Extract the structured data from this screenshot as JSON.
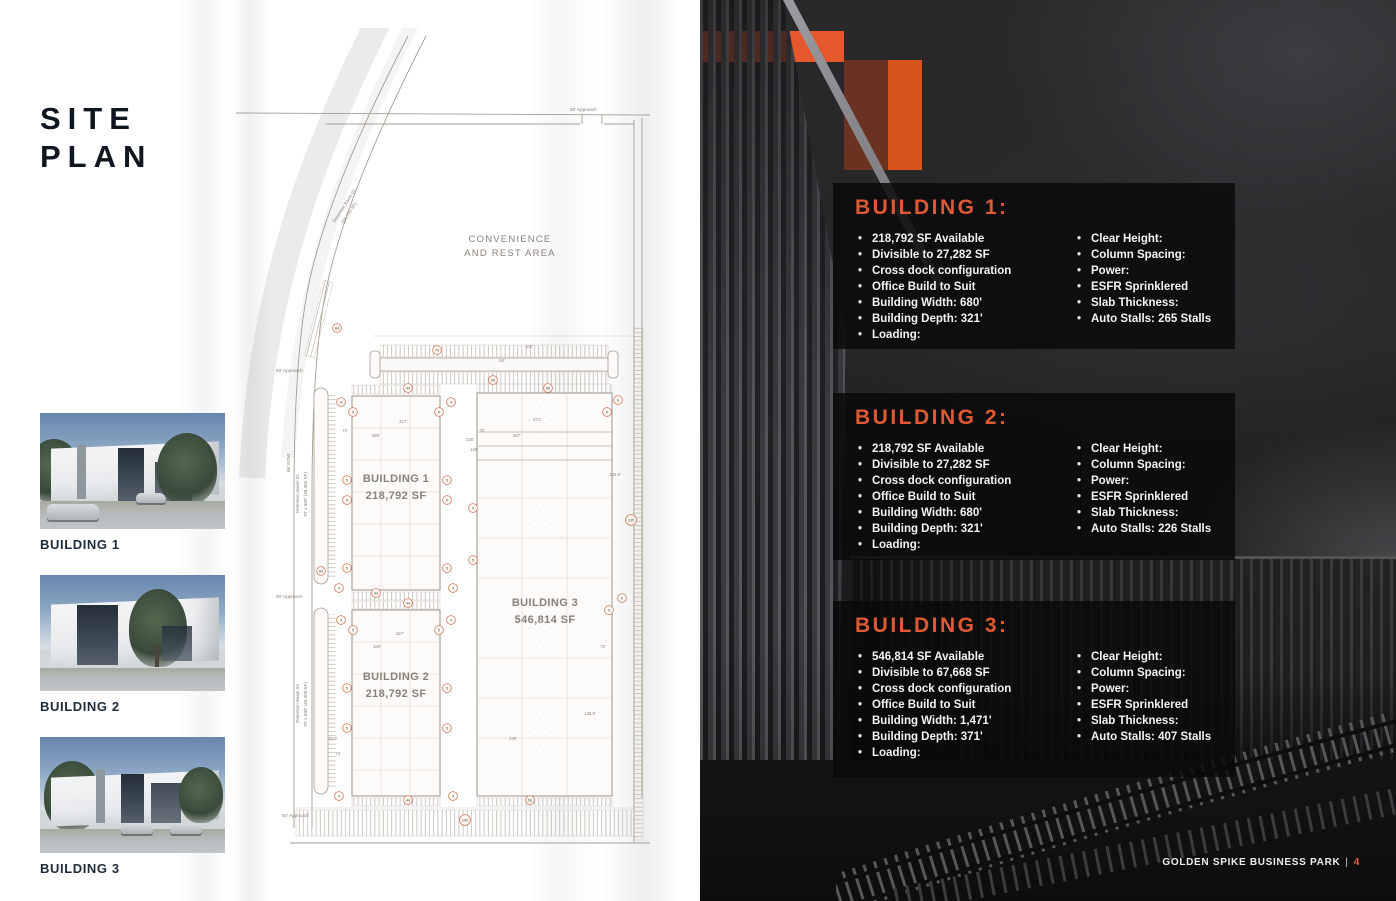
{
  "page": {
    "title_line1": "SITE",
    "title_line2": "PLAN"
  },
  "colors": {
    "accent_orange": "#E4582B",
    "heading_orange": "#DD5A35",
    "navy_text": "#1D2B3A",
    "panel_background": "rgba(10,10,11,0.84)"
  },
  "thumbnails": [
    {
      "label": "BUILDING 1"
    },
    {
      "label": "BUILDING 2"
    },
    {
      "label": "BUILDING 3"
    }
  ],
  "site_plan": {
    "area_label_line1": "CONVENIENCE",
    "area_label_line2": "AND REST AREA",
    "approach_label": "50' Approach",
    "row_label": "66' ROW",
    "basin1_line1": "Detention Basin 01",
    "basin1_line2": "(86,745 SF)",
    "basin2_line1": "Detention Basin 02",
    "basin2_line2": "70' x 690' (48,300 SF)",
    "basin3_line1": "Detention Basin 03",
    "basin3_line2": "70' x 690' (48,300 SF)",
    "buildings": [
      {
        "name": "BUILDING 1",
        "sf": "218,792 SF"
      },
      {
        "name": "BUILDING 2",
        "sf": "218,792 SF"
      },
      {
        "name": "BUILDING 3",
        "sf": "546,814 SF"
      }
    ],
    "dimensions": [
      {
        "t": "100'",
        "x": 299,
        "y": 320
      },
      {
        "t": "50'",
        "x": 272,
        "y": 334
      },
      {
        "t": "317'",
        "x": 173,
        "y": 395
      },
      {
        "t": "680'",
        "x": 146,
        "y": 409
      },
      {
        "t": "72'",
        "x": 115,
        "y": 404
      },
      {
        "t": "371'",
        "x": 307,
        "y": 393
      },
      {
        "t": "547'",
        "x": 287,
        "y": 409
      },
      {
        "t": "76'",
        "x": 252,
        "y": 404
      },
      {
        "t": "230'",
        "x": 240,
        "y": 413
      },
      {
        "t": "148'",
        "x": 244,
        "y": 423
      },
      {
        "t": "183.9'",
        "x": 385,
        "y": 448
      },
      {
        "t": "327'",
        "x": 170,
        "y": 607
      },
      {
        "t": "180'",
        "x": 147,
        "y": 620
      },
      {
        "t": "53.5'",
        "x": 103,
        "y": 712
      },
      {
        "t": "72'",
        "x": 108,
        "y": 727
      },
      {
        "t": "230'",
        "x": 283,
        "y": 712
      },
      {
        "t": "136.9'",
        "x": 360,
        "y": 687
      },
      {
        "t": "72'",
        "x": 373,
        "y": 620
      }
    ],
    "badges": [
      {
        "n": "84",
        "x": 107,
        "y": 300
      },
      {
        "n": "75",
        "x": 207,
        "y": 322
      },
      {
        "n": "95",
        "x": 263,
        "y": 352
      },
      {
        "n": "44",
        "x": 178,
        "y": 360
      },
      {
        "n": "58",
        "x": 318,
        "y": 360
      },
      {
        "n": "4",
        "x": 111,
        "y": 374
      },
      {
        "n": "5",
        "x": 123,
        "y": 384
      },
      {
        "n": "5",
        "x": 209,
        "y": 384
      },
      {
        "n": "4",
        "x": 221,
        "y": 374
      },
      {
        "n": "5",
        "x": 117,
        "y": 452
      },
      {
        "n": "5",
        "x": 217,
        "y": 452
      },
      {
        "n": "5",
        "x": 117,
        "y": 472
      },
      {
        "n": "5",
        "x": 217,
        "y": 472
      },
      {
        "n": "83",
        "x": 91,
        "y": 543
      },
      {
        "n": "5",
        "x": 117,
        "y": 540
      },
      {
        "n": "5",
        "x": 217,
        "y": 540
      },
      {
        "n": "4",
        "x": 109,
        "y": 560
      },
      {
        "n": "4",
        "x": 223,
        "y": 560
      },
      {
        "n": "44",
        "x": 146,
        "y": 565
      },
      {
        "n": "44",
        "x": 178,
        "y": 575
      },
      {
        "n": "5",
        "x": 243,
        "y": 480
      },
      {
        "n": "5",
        "x": 243,
        "y": 532
      },
      {
        "n": "6",
        "x": 388,
        "y": 372
      },
      {
        "n": "5",
        "x": 377,
        "y": 384
      },
      {
        "n": "6",
        "x": 392,
        "y": 570
      },
      {
        "n": "5",
        "x": 379,
        "y": 582
      },
      {
        "n": "4",
        "x": 111,
        "y": 592
      },
      {
        "n": "5",
        "x": 123,
        "y": 602
      },
      {
        "n": "5",
        "x": 209,
        "y": 602
      },
      {
        "n": "4",
        "x": 221,
        "y": 592
      },
      {
        "n": "5",
        "x": 117,
        "y": 660
      },
      {
        "n": "5",
        "x": 217,
        "y": 660
      },
      {
        "n": "5",
        "x": 117,
        "y": 700
      },
      {
        "n": "5",
        "x": 217,
        "y": 700
      },
      {
        "n": "4",
        "x": 109,
        "y": 768
      },
      {
        "n": "4",
        "x": 223,
        "y": 768
      },
      {
        "n": "44",
        "x": 178,
        "y": 772
      },
      {
        "n": "56",
        "x": 300,
        "y": 772
      },
      {
        "n": "108",
        "x": 235,
        "y": 792
      },
      {
        "n": "195",
        "x": 401,
        "y": 492
      }
    ]
  },
  "panels": [
    {
      "title": "BUILDING 1:",
      "left": [
        "218,792 SF Available",
        "Divisible to  27,282 SF",
        "Cross dock configuration",
        "Office Build to Suit",
        "Building Width: 680'",
        "Building Depth: 321'",
        "Loading:"
      ],
      "right": [
        "Clear Height:",
        "Column Spacing:",
        "Power:",
        "ESFR Sprinklered",
        "Slab Thickness:",
        "Auto Stalls: 265 Stalls"
      ]
    },
    {
      "title": "BUILDING 2:",
      "left": [
        "218,792 SF Available",
        "Divisible to  27,282 SF",
        "Cross dock configuration",
        "Office Build to Suit",
        "Building Width: 680'",
        "Building Depth: 321'",
        "Loading:"
      ],
      "right": [
        "Clear Height:",
        "Column Spacing:",
        "Power:",
        "ESFR Sprinklered",
        "Slab Thickness:",
        "Auto Stalls: 226 Stalls"
      ]
    },
    {
      "title": "BUILDING 3:",
      "left": [
        "546,814 SF Available",
        "Divisible to  67,668 SF",
        "Cross dock configuration",
        "Office Build to Suit",
        "Building Width: 1,471'",
        "Building Depth: 371'",
        "Loading:"
      ],
      "right": [
        "Clear Height:",
        "Column Spacing:",
        "Power:",
        "ESFR Sprinklered",
        "Slab Thickness:",
        "Auto Stalls: 407 Stalls"
      ]
    }
  ],
  "footer": {
    "brand": "GOLDEN SPIKE BUSINESS PARK",
    "separator": "|",
    "page": "4"
  }
}
